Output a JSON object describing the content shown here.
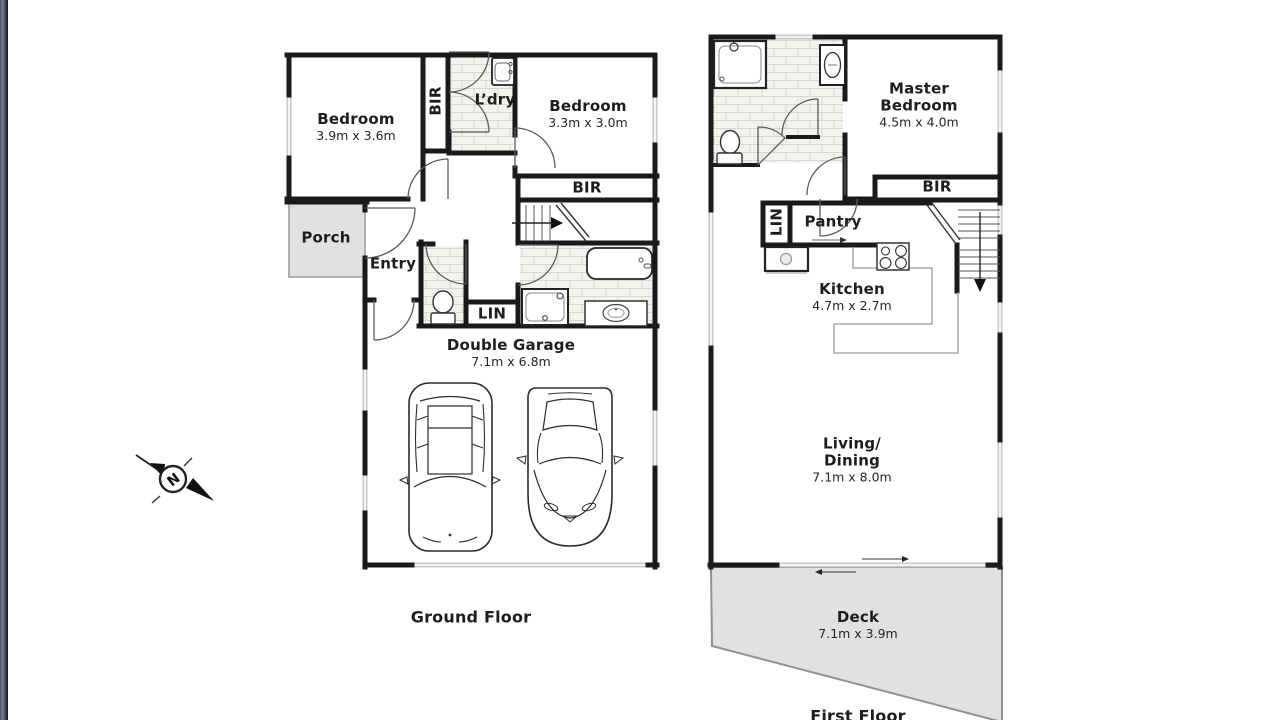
{
  "ground_floor": {
    "title": "Ground Floor",
    "bedroom1": {
      "name": "Bedroom",
      "size": "3.9m x 3.6m"
    },
    "bedroom1_bir": "BIR",
    "laundry": "L’dry",
    "bedroom2": {
      "name": "Bedroom",
      "size": "3.3m x 3.0m"
    },
    "bedroom2_bir": "BIR",
    "porch": "Porch",
    "entry": "Entry",
    "linen": "LIN",
    "garage": {
      "name": "Double Garage",
      "size": "7.1m x 6.8m"
    }
  },
  "first_floor": {
    "title": "First Floor",
    "master_bedroom": {
      "name_line1": "Master",
      "name_line2": "Bedroom",
      "size": "4.5m x 4.0m"
    },
    "bir": "BIR",
    "linen": "LIN",
    "pantry": "Pantry",
    "kitchen": {
      "name": "Kitchen",
      "size": "4.7m x 2.7m"
    },
    "living": {
      "name_line1": "Living/",
      "name_line2": "Dining",
      "size": "7.1m x 8.0m"
    },
    "deck": {
      "name": "Deck",
      "size": "7.1m x 3.9m"
    }
  },
  "compass": {
    "north_label": "N"
  },
  "colors": {
    "wall": "#1a1a1a",
    "floor_gray": "#e1e1e1",
    "window": "#c9c9c9",
    "tile_line": "#d9d5cf"
  }
}
